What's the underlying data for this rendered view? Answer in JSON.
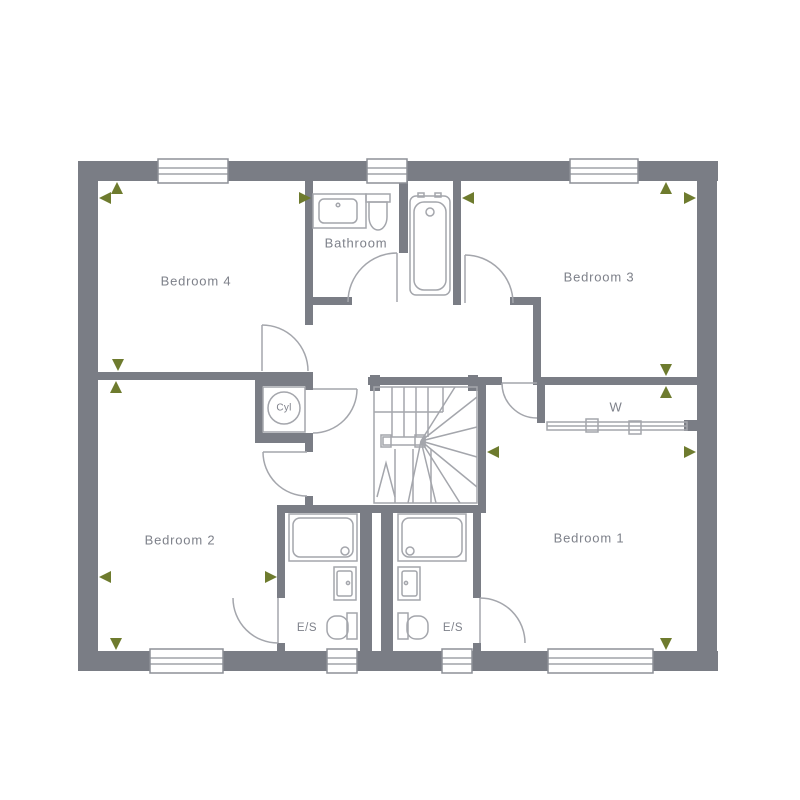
{
  "plan": {
    "type": "floor-plan",
    "rooms": [
      {
        "id": "bedroom-4",
        "label": "Bedroom 4"
      },
      {
        "id": "bathroom",
        "label": "Bathroom"
      },
      {
        "id": "bedroom-3",
        "label": "Bedroom 3"
      },
      {
        "id": "wardrobe",
        "label": "W"
      },
      {
        "id": "cylinder-cupboard",
        "label": "Cyl"
      },
      {
        "id": "bedroom-2",
        "label": "Bedroom 2"
      },
      {
        "id": "bedroom-1",
        "label": "Bedroom 1"
      },
      {
        "id": "ensuite-left",
        "label": "E/S"
      },
      {
        "id": "ensuite-right",
        "label": "E/S"
      }
    ],
    "symbols": [
      "bathtub",
      "basin",
      "toilet",
      "shower-tray",
      "winder-stairs",
      "cylinder",
      "sliding-wardrobe-door",
      "hinged-door",
      "window",
      "dimension-arrow"
    ],
    "colors": {
      "wall": "#7a7d85",
      "fixture_line": "#a4a6ac",
      "label_text": "#7e818a",
      "dimension_arrow": "#6e7b2e",
      "background": "#ffffff"
    }
  }
}
